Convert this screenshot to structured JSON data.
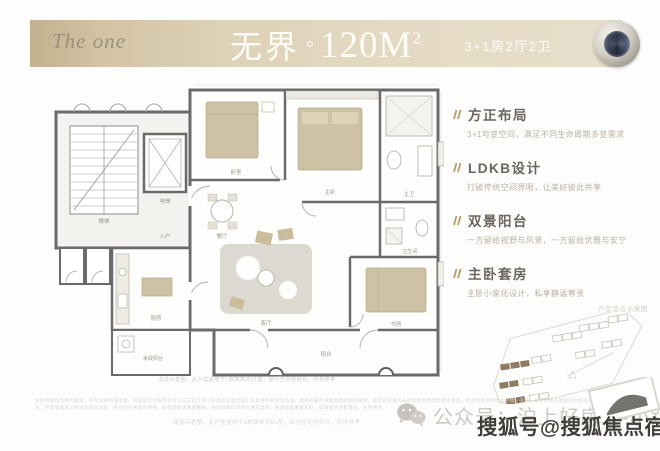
{
  "header": {
    "logo": "The one",
    "title_cn": "无界",
    "area_num": "120M",
    "area_sup": "2",
    "spec": "3+1房2厅2卫"
  },
  "features": {
    "items": [
      {
        "title": "方正布局",
        "desc": "3+1可变空间，满足不同生命周期多变需求"
      },
      {
        "title": "LDKB设计",
        "desc": "打破传统空间界限，让美好彼此共享"
      },
      {
        "title": "双景阳台",
        "desc": "一方留给视野与风景，一方留给优雅与安宁"
      },
      {
        "title": "主卧套房",
        "desc": "主卧小家化设计，私享静谧尊贵"
      }
    ]
  },
  "siteplan": {
    "label": "户型落位示意图"
  },
  "floorplan": {
    "rooms": {
      "stairs": "楼梯",
      "elevator": "电梯",
      "entry": "入户",
      "kitchen": "厨房",
      "laundry": "家政阳台",
      "dining": "餐厅",
      "living": "客厅",
      "balcony": "阳台",
      "bedroom": "卧室",
      "master": "主卧",
      "master_bath": "主卫",
      "bath": "卫生间",
      "study": "书房"
    },
    "note": "改造示意图，此户型适用于1栋西单元01室，部分空间经转化，仅供参考"
  },
  "footer": {
    "fineprint": "本宣传资料为要约邀请，不作为要约或承诺，买卖双方的权利义务以双方签订的《商品房买卖合同》及其附件等协议为准。相关内容不排除因政府相关规划、规定及开发商未能控制的原因而发生变化。本资料对项目周边环境、交通、教育及商业配套的介绍旨在提供相关信息，不意味着本公司对此作出承诺。部分图片来源于网络，如有侵权请联系删除。本资料制作时间为发布当日，敬请留意最新资料，详情请咨询售楼处，仅供参考。",
    "note": "改造示意图，此户型适用于1栋西单元01室，部分空间经转化，仅供参考",
    "wechat_label": "公众号：沪上好房汇-小跃",
    "watermark": "搜狐号@搜狐焦点宿州站"
  },
  "colors": {
    "band_tan": "#d8cbae",
    "accent_gold": "#b59c6d",
    "heading_gray": "#6b655e",
    "furniture_beige": "#cec2a4",
    "wall_gray": "#6a6a6a",
    "watermark_dark": "#413e3a"
  }
}
